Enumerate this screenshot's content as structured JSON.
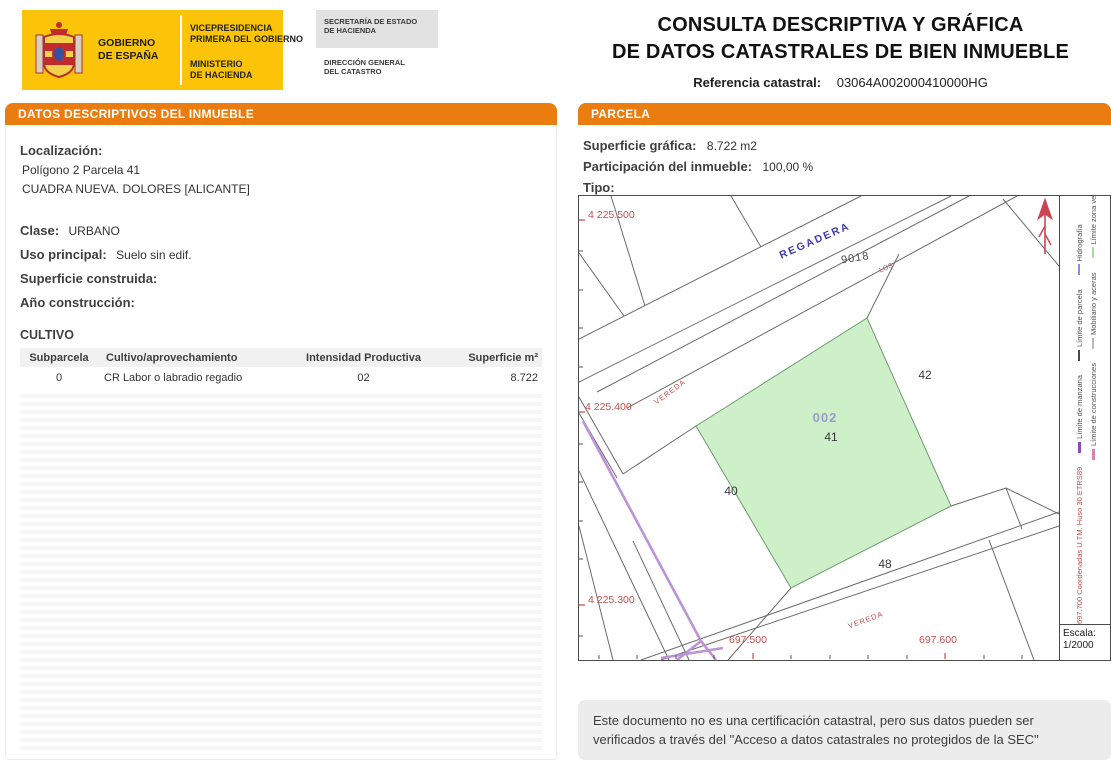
{
  "header": {
    "logo": {
      "gobierno_l1": "GOBIERNO",
      "gobierno_l2": "DE ESPAÑA",
      "vicepresidencia_l1": "VICEPRESIDENCIA",
      "vicepresidencia_l2": "PRIMERA DEL GOBIERNO",
      "ministerio_l1": "MINISTERIO",
      "ministerio_l2": "DE HACIENDA",
      "secretaria_l1": "SECRETARÍA DE ESTADO",
      "secretaria_l2": "DE HACIENDA",
      "direccion_l1": "DIRECCIÓN GENERAL",
      "direccion_l2": "DEL CATASTRO"
    },
    "title_line1": "CONSULTA DESCRIPTIVA Y GRÁFICA",
    "title_line2": "DE DATOS CATASTRALES DE BIEN INMUEBLE",
    "ref_label": "Referencia catastral:",
    "ref_value": "03064A002000410000HG"
  },
  "left_panel": {
    "header": "DATOS DESCRIPTIVOS DEL INMUEBLE",
    "localizacion_label": "Localización:",
    "localizacion_line1": "Polígono 2 Parcela 41",
    "localizacion_line2": "CUADRA NUEVA. DOLORES [ALICANTE]",
    "clase_label": "Clase:",
    "clase_value": "URBANO",
    "uso_label": "Uso principal:",
    "uso_value": "Suelo sin edif.",
    "superficie_label": "Superficie construida:",
    "superficie_value": "",
    "anio_label": "Año construcción:",
    "anio_value": "",
    "cultivo_title": "CULTIVO",
    "table": {
      "headers": [
        "Subparcela",
        "Cultivo/aprovechamiento",
        "Intensidad Productiva",
        "Superficie m²"
      ],
      "rows": [
        [
          "0",
          "CR Labor o labradio regadio",
          "02",
          "8.722"
        ]
      ]
    }
  },
  "right_panel": {
    "header": "PARCELA",
    "superficie_label": "Superficie gráfica:",
    "superficie_value": "8.722 m2",
    "participacion_label": "Participación del inmueble:",
    "participacion_value": "100,00 %",
    "tipo_label": "Tipo:",
    "tipo_value": ""
  },
  "map": {
    "y_coords": [
      "4 225.500",
      "4 225.400",
      "4 225.300"
    ],
    "x_coords": [
      "697.500",
      "697.600"
    ],
    "waterway_label": "REGADERA",
    "waterway_prefix": "LOS",
    "waterway_parcel": "9018",
    "path_label_left": "VEREDA",
    "path_label_bottom": "VEREDA",
    "subparcel_code": "002",
    "parcel_main": "41",
    "parcel_right": "42",
    "parcel_left": "40",
    "parcel_bottom": "48",
    "colors": {
      "highlight_fill": "#cdf0c9",
      "highlight_stroke": "#6f9b6f",
      "boundary": "#6a6a6a",
      "cattle_path": "#bd93d8",
      "coord_red": "#c0504d",
      "waterway_blue": "#3b3baf",
      "subparcel_purple": "#9b9bd0"
    }
  },
  "legend": {
    "row1": [
      {
        "label": "Límite de manzana",
        "color": "#8a4fb5"
      },
      {
        "label": "Límite de parcela",
        "color": "#4a4a4a"
      },
      {
        "label": "Hidrografía",
        "color": "#8e8ed2"
      }
    ],
    "row2": [
      {
        "label": "Límite de construcciones",
        "color": "#d582b4"
      },
      {
        "label": "Mobiliario y aceras",
        "color": "#b8b8b8"
      },
      {
        "label": "Límite zona verde",
        "color": "#a8e0a0"
      }
    ],
    "coords_note": "697.700 Coordenadas U.TM. Huso 30 ETRS89",
    "scale_label": "Escala:",
    "scale_value": "1/2000"
  },
  "footer": {
    "disclaimer": "Este documento no es una certificación catastral, pero sus datos pueden ser verificados a través del \"Acceso a datos catastrales no protegidos de la SEC\""
  }
}
